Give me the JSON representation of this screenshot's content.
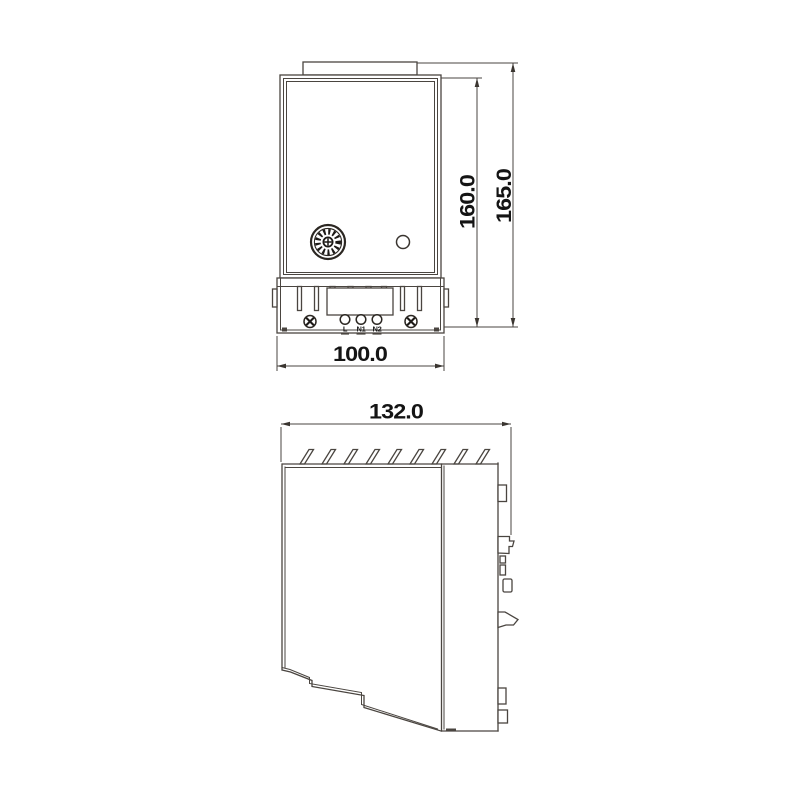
{
  "drawing": {
    "type": "technical-dimension-drawing",
    "background": "#ffffff",
    "line_color": "#4a4540",
    "text_color": "#141414",
    "front_view": {
      "name": "front-view",
      "dim_height_body": "160.0",
      "dim_height_total": "165.0",
      "dim_width": "100.0",
      "terminals": [
        "L",
        "N1",
        "N2"
      ]
    },
    "side_view": {
      "name": "side-view",
      "dim_depth": "132.0"
    },
    "icons": {
      "dial": "thermostat-dial-icon",
      "indicator": "indicator-hole-icon",
      "screw": "screw-cross-icon",
      "terminal": "terminal-hole-icon",
      "fins": "heatsink-fin-icon",
      "clip": "din-rail-clip-icon"
    }
  }
}
